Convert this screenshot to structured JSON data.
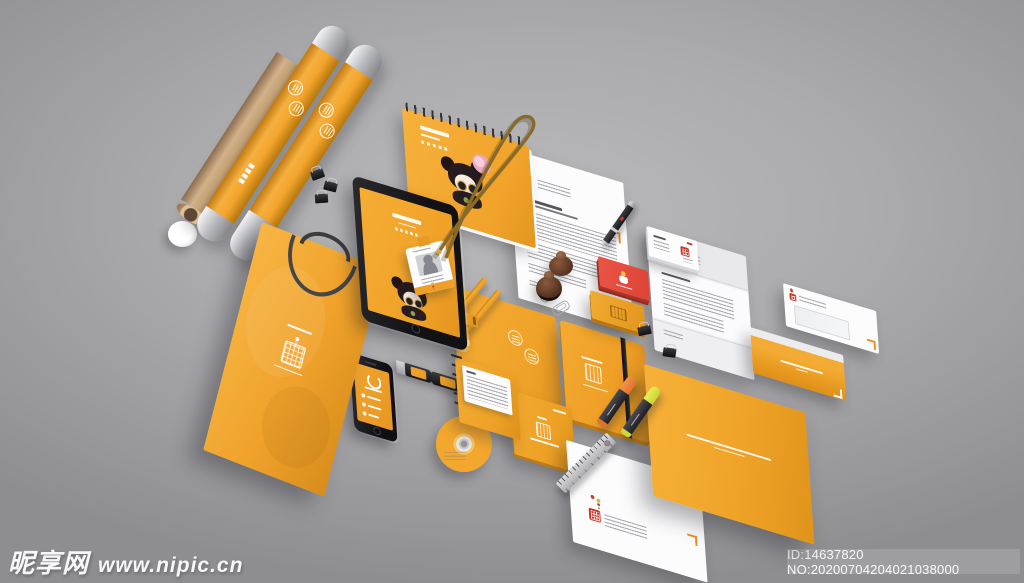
{
  "watermark": {
    "site_name": "昵享网",
    "site_url": "www.nipic.cn",
    "id_label": "ID:14637820 NO:20200704204021038000"
  },
  "scene": {
    "description": "Corporate brand identity stationery mockup, angled top view on gray studio background",
    "mascot": "Beijing-opera girl cartoon character on tablet and calendar covers"
  },
  "palette": {
    "brand_orange": "#F2A52C",
    "brand_red_seal": "#C5392C",
    "background_gray": "#A9A9AC",
    "kraft_tan": "#C8A57E",
    "black": "#1B1B1E",
    "white_paper": "#FCFCFD"
  },
  "items": [
    {
      "name": "kraft-paper-tube",
      "color": "#C8A57E"
    },
    {
      "name": "poster-tube-1",
      "color": "#F2A52C"
    },
    {
      "name": "poster-tube-2",
      "color": "#F2A52C"
    },
    {
      "name": "white-cap",
      "color": "#FFFFFF"
    },
    {
      "name": "binder-clips",
      "color": "#1B1B1E"
    },
    {
      "name": "shopping-bag",
      "color": "#F2A52C"
    },
    {
      "name": "desk-calendar-spiral",
      "color": "#F2A52C"
    },
    {
      "name": "tablet",
      "color": "#1B1B1E"
    },
    {
      "name": "lanyard-id-badge",
      "color": "#8A6A26"
    },
    {
      "name": "letterhead",
      "color": "#FCFCFD"
    },
    {
      "name": "ballpoint-pen",
      "color": "#26262A"
    },
    {
      "name": "business-cards-white",
      "color": "#FCFCFD"
    },
    {
      "name": "business-cards-red",
      "color": "#E2493C"
    },
    {
      "name": "card-case",
      "color": "#F0A42C"
    },
    {
      "name": "wooden-stamps",
      "color": "#5F3A26"
    },
    {
      "name": "spiral-notebook",
      "color": "#F2A42C"
    },
    {
      "name": "elastic-band-notebook",
      "color": "#EF9F27"
    },
    {
      "name": "smartphone",
      "color": "#17171A"
    },
    {
      "name": "usb-drives",
      "color": "#26262A"
    },
    {
      "name": "button-badges",
      "color": "#F0A42C"
    },
    {
      "name": "pencils",
      "color": "#F0A22A"
    },
    {
      "name": "eraser-and-sharpener",
      "color": "#F2A42E"
    },
    {
      "name": "cd-disc-and-sleeve",
      "color": "#F3A72E"
    },
    {
      "name": "cd-case",
      "color": "#F0A32B"
    },
    {
      "name": "folded-letter",
      "color": "#F4F4F6"
    },
    {
      "name": "window-envelope",
      "color": "#FCFCFD"
    },
    {
      "name": "orange-envelope",
      "color": "#F4AB33"
    },
    {
      "name": "document-folder",
      "color": "#F2A52C"
    },
    {
      "name": "letterhead-bottom",
      "color": "#FCFCFD"
    },
    {
      "name": "highlighter-markers",
      "color": "#F07E28"
    },
    {
      "name": "steel-ruler",
      "color": "#C7C7CB"
    }
  ]
}
